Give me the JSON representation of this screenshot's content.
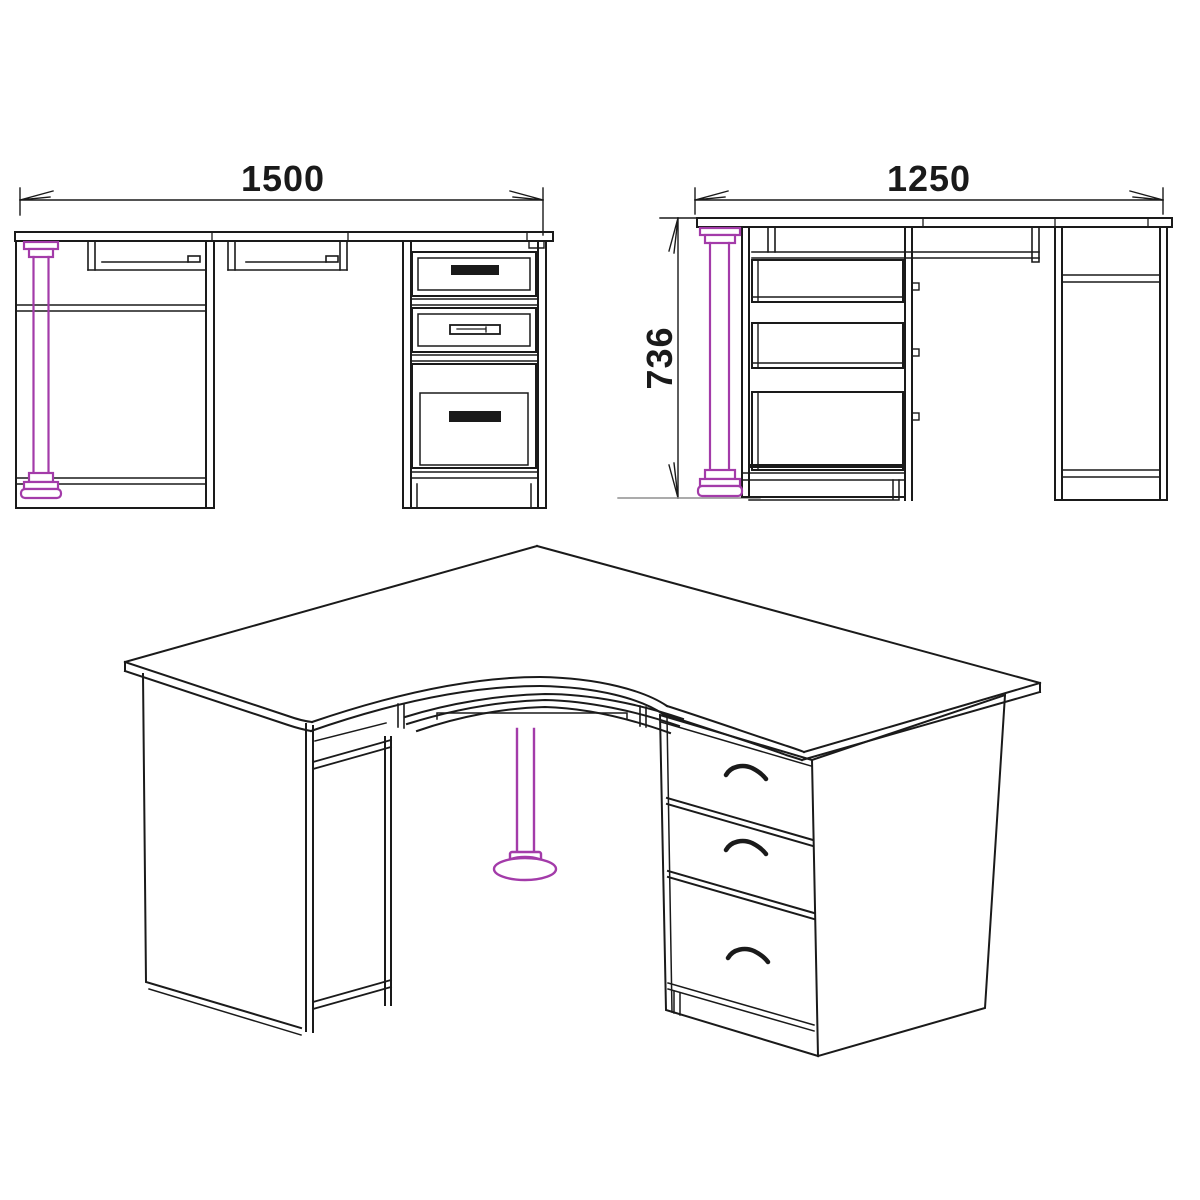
{
  "drawing": {
    "subject": "Corner computer desk — dimensioned technical drawing",
    "views": {
      "front": {
        "name": "front view",
        "width_label": "1500"
      },
      "side": {
        "name": "side view",
        "depth_label": "1250",
        "height_label": "736"
      },
      "isometric": {
        "name": "isometric view"
      }
    },
    "colors": {
      "line": "#1a1a1a",
      "leg_accent": "#a33ba9",
      "extension_line": "#8f8f8f",
      "background": "#ffffff"
    }
  }
}
